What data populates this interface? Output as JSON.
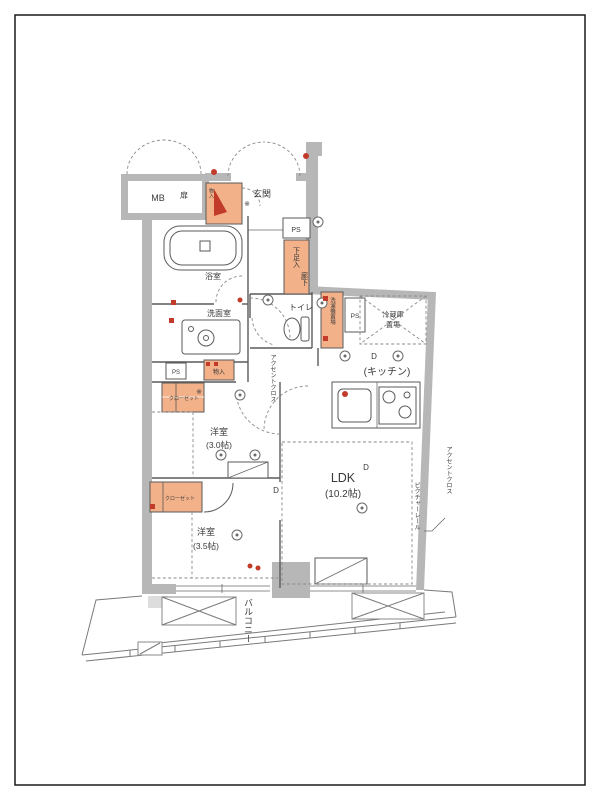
{
  "page": {
    "type": "japanese-apartment-floor-plan"
  },
  "labels": {
    "mb": "MB",
    "mb_tag": "扉",
    "entrance": "玄関",
    "ps": "PS",
    "shoe_cabinet": "下足入",
    "storage": "物入",
    "toilet": "トイレ",
    "bath": "浴室",
    "washroom": "洗面室",
    "hallway": "廊下",
    "washer": "洗濯機置場",
    "fridge_1": "冷蔵庫",
    "fridge_2": "置場",
    "kitchen": "(キッチン)",
    "ldk": "LDK",
    "ldk_size": "(10.2帖)",
    "bedroom_a": "洋室",
    "bedroom_a_size": "(3.0帖)",
    "bedroom_b": "洋室",
    "bedroom_b_size": "(3.5帖)",
    "closet": "クローゼット",
    "balcony": "バルコニー",
    "accent_cloth": "アクセントクロス",
    "picture_rail": "ピクチャーレール",
    "door": "D",
    "note": "※"
  },
  "colors": {
    "wall": "#b7b7b7",
    "storage": "#f2b189",
    "accent_red": "#c23b2a",
    "line": "#4a4a4a",
    "frame": "#1a1a1a"
  }
}
